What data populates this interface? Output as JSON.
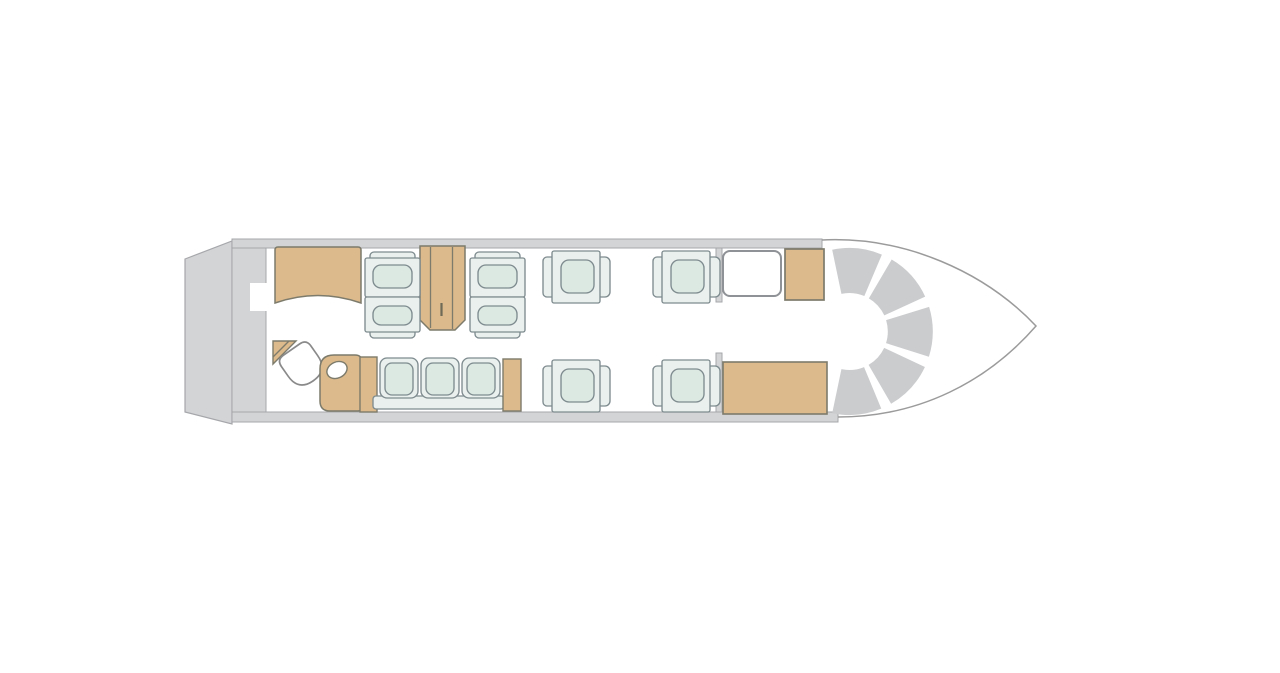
{
  "canvas": {
    "width": 1280,
    "height": 673,
    "background": "#ffffff"
  },
  "diagram": {
    "kind": "aircraft-cabin-floorplan",
    "orientation": "nose-right-tail-left"
  },
  "palette": {
    "wall": "#d3d4d6",
    "wallline": "#a6a7ab",
    "arc": "#cbccce",
    "tan": "#dcba8c",
    "tanline": "#7d7b6b",
    "handle": "#6f6a58",
    "seatline": "#7e8b8f",
    "seatbody": "#eaf0ed",
    "cushion": "#dce9e3",
    "white": "#ffffff",
    "noseline": "#9b9b9b",
    "toiletline": "#8a8a8a",
    "doorline": "#8f9296"
  },
  "shapes": [
    {
      "kind": "polygon",
      "name": "tail-cone",
      "points": "185,259 232,241 232,424 185,412",
      "fill": "wall",
      "stroke": "wallline",
      "sw": 1.2
    },
    {
      "kind": "rect",
      "name": "rear-bulkhead",
      "x": 232,
      "y": 239,
      "w": 34,
      "h": 183,
      "fill": "wall",
      "stroke": "wallline",
      "sw": 1
    },
    {
      "kind": "rect",
      "name": "top-cabin-wall",
      "x": 232,
      "y": 239,
      "w": 590,
      "h": 9,
      "fill": "wall",
      "stroke": "wallline",
      "sw": 1
    },
    {
      "kind": "rect",
      "name": "bottom-cabin-wall",
      "x": 232,
      "y": 412,
      "w": 606,
      "h": 10,
      "fill": "wall",
      "stroke": "wallline",
      "sw": 1
    },
    {
      "kind": "rect",
      "name": "rear-doorway-notch",
      "x": 250,
      "y": 283,
      "w": 17,
      "h": 28,
      "fill": "white"
    },
    {
      "kind": "path",
      "name": "nose-outline",
      "d": "M822,240 C905,236 985,272 1036,326 C988,381 920,417 838,417",
      "fill": "none",
      "stroke": "noseline",
      "sw": 1.5
    },
    {
      "kind": "path",
      "name": "cockpit-instrument-panel",
      "d": "M836.8,271.8 A61,61 0 1 1 836.8,391.2",
      "fill": "none",
      "stroke": "arc",
      "sw": 45,
      "dash": "37.05 8"
    },
    {
      "kind": "rect",
      "name": "entry-partition-top",
      "x": 716,
      "y": 248,
      "w": 6,
      "h": 54,
      "fill": "wall",
      "stroke": "wallline",
      "sw": 1
    },
    {
      "kind": "rect",
      "name": "entry-partition-bottom",
      "x": 716,
      "y": 353,
      "w": 6,
      "h": 59,
      "fill": "wall",
      "stroke": "wallline",
      "sw": 1
    },
    {
      "kind": "path",
      "name": "aft-galley-cabinet",
      "d": "M278,247 h80 q3,0 3,3 v53 q-43,-15 -86,0 v-53 q0,-3 3,-3 z",
      "fill": "tan",
      "stroke": "tanline",
      "sw": 1.5
    },
    {
      "kind": "path",
      "name": "wardrobe-cabinet",
      "d": "M420,246 h45 v74 l-10,10 h-25 l-10,-10 z",
      "fill": "tan",
      "stroke": "tanline",
      "sw": 1.5
    },
    {
      "kind": "line",
      "name": "wardrobe-door-seam-left",
      "x1": 430.5,
      "y1": 247,
      "x2": 430.5,
      "y2": 328,
      "stroke": "tanline",
      "sw": 1.3
    },
    {
      "kind": "line",
      "name": "wardrobe-door-seam-right",
      "x1": 452.5,
      "y1": 247,
      "x2": 452.5,
      "y2": 329,
      "stroke": "tanline",
      "sw": 1.3
    },
    {
      "kind": "line",
      "name": "wardrobe-handle",
      "x1": 441.5,
      "y1": 303,
      "x2": 441.5,
      "y2": 316,
      "stroke": "handle",
      "sw": 2.2
    },
    {
      "kind": "path",
      "name": "lavatory-corner-shelf",
      "d": "M273,341 h23 l-23,23 z",
      "fill": "tan",
      "stroke": "tanline",
      "sw": 1.4
    },
    {
      "kind": "line",
      "name": "lavatory-shelf-seam",
      "x1": 289,
      "y1": 341,
      "x2": 273,
      "y2": 357,
      "stroke": "tanline",
      "sw": 1.3
    },
    {
      "kind": "path",
      "name": "toilet",
      "d": "M-18,-12 q0,-8 8,-8 h20 q8,0 8,8 v12 q0,18 -18,18 q-18,0 -18,-18 z",
      "transform": "translate(303,366) rotate(-35)",
      "fill": "white",
      "stroke": "toiletline",
      "sw": 1.7
    },
    {
      "kind": "path",
      "name": "vanity-cabinet",
      "d": "M334,355 h21 q7,0 7,7 v45 q0,4 -4,4 h-28 q-10,0 -10,-10 v-32 q0,-14 14,-14 z",
      "fill": "tan",
      "stroke": "tanline",
      "sw": 1.5
    },
    {
      "kind": "ellipse",
      "name": "sink-basin",
      "cx": 337,
      "cy": 370,
      "rx": 10.5,
      "ry": 8,
      "rotate": -25,
      "fill": "white",
      "stroke": "tanline",
      "sw": 1.4
    },
    {
      "kind": "rect",
      "name": "divan-side-cabinet-aft",
      "x": 360,
      "y": 357,
      "w": 17,
      "h": 55,
      "fill": "tan",
      "stroke": "tanline",
      "sw": 1.4
    },
    {
      "kind": "divan",
      "name": "three-seat-divan",
      "cushions_x": [
        380,
        421,
        462
      ],
      "y": 358,
      "cw": 38,
      "ch": 40,
      "band": {
        "x": 373,
        "y": 396,
        "w": 131,
        "h": 13
      }
    },
    {
      "kind": "rect",
      "name": "divan-side-cabinet-fwd",
      "x": 503,
      "y": 359,
      "w": 18,
      "h": 52,
      "fill": "tan",
      "stroke": "tanline",
      "sw": 1.4
    },
    {
      "kind": "seat",
      "name": "club-seat-aft-outboard",
      "x": 365,
      "y": 252,
      "w": 55,
      "h": 45,
      "orient": "up"
    },
    {
      "kind": "seat",
      "name": "club-seat-aft-inboard",
      "x": 365,
      "y": 297,
      "w": 55,
      "h": 41,
      "orient": "down"
    },
    {
      "kind": "seat",
      "name": "club-seat-fwd-outboard",
      "x": 470,
      "y": 252,
      "w": 55,
      "h": 45,
      "orient": "up"
    },
    {
      "kind": "seat",
      "name": "club-seat-fwd-inboard",
      "x": 470,
      "y": 297,
      "w": 55,
      "h": 41,
      "orient": "down"
    },
    {
      "kind": "seat",
      "name": "single-seat-mid-port-aft",
      "x": 543,
      "y": 251,
      "w": 68,
      "h": 52,
      "orient": "left"
    },
    {
      "kind": "seat",
      "name": "single-seat-mid-port-fwd",
      "x": 653,
      "y": 251,
      "w": 68,
      "h": 52,
      "orient": "left"
    },
    {
      "kind": "seat",
      "name": "single-seat-mid-stbd-aft",
      "x": 543,
      "y": 360,
      "w": 68,
      "h": 52,
      "orient": "left"
    },
    {
      "kind": "seat",
      "name": "single-seat-mid-stbd-fwd",
      "x": 653,
      "y": 360,
      "w": 68,
      "h": 52,
      "orient": "left"
    },
    {
      "kind": "rect",
      "name": "entry-door",
      "x": 723,
      "y": 251,
      "w": 58,
      "h": 45,
      "rx": 7,
      "fill": "white",
      "stroke": "doorline",
      "sw": 2
    },
    {
      "kind": "rect",
      "name": "fwd-cabinet-top",
      "x": 785,
      "y": 249,
      "w": 39,
      "h": 51,
      "fill": "tan",
      "stroke": "tanline",
      "sw": 1.7
    },
    {
      "kind": "rect",
      "name": "fwd-galley-cabinet-bottom",
      "x": 723,
      "y": 362,
      "w": 104,
      "h": 52,
      "fill": "tan",
      "stroke": "tanline",
      "sw": 1.6
    }
  ]
}
